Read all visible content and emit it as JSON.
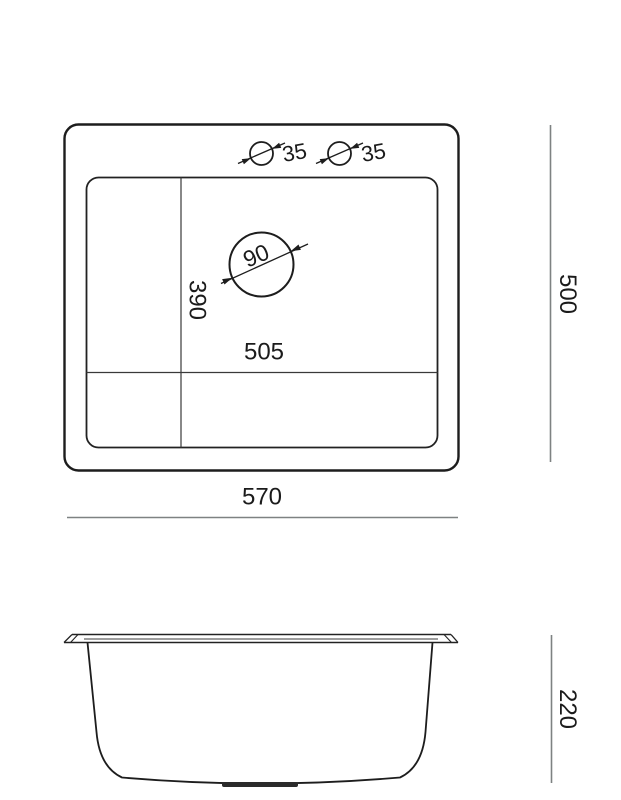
{
  "drawing": {
    "type": "sink-technical-drawing",
    "units_visible": false,
    "top_view": {
      "faucet_hole_left_diameter": "35",
      "faucet_hole_right_diameter": "35",
      "drain_hole_diameter": "90",
      "inner_bowl_depth": "390",
      "inner_bowl_width": "505",
      "overall_width": "570",
      "overall_depth": "500"
    },
    "side_view": {
      "overall_height": "220"
    },
    "colors": {
      "outline": "#1d1d1d",
      "interior_line": "#3a3a3a",
      "dimension_line": "#7e8282",
      "text": "#1b1b1b",
      "drain_fill": "#2b2b2b",
      "background": "#ffffff"
    }
  }
}
